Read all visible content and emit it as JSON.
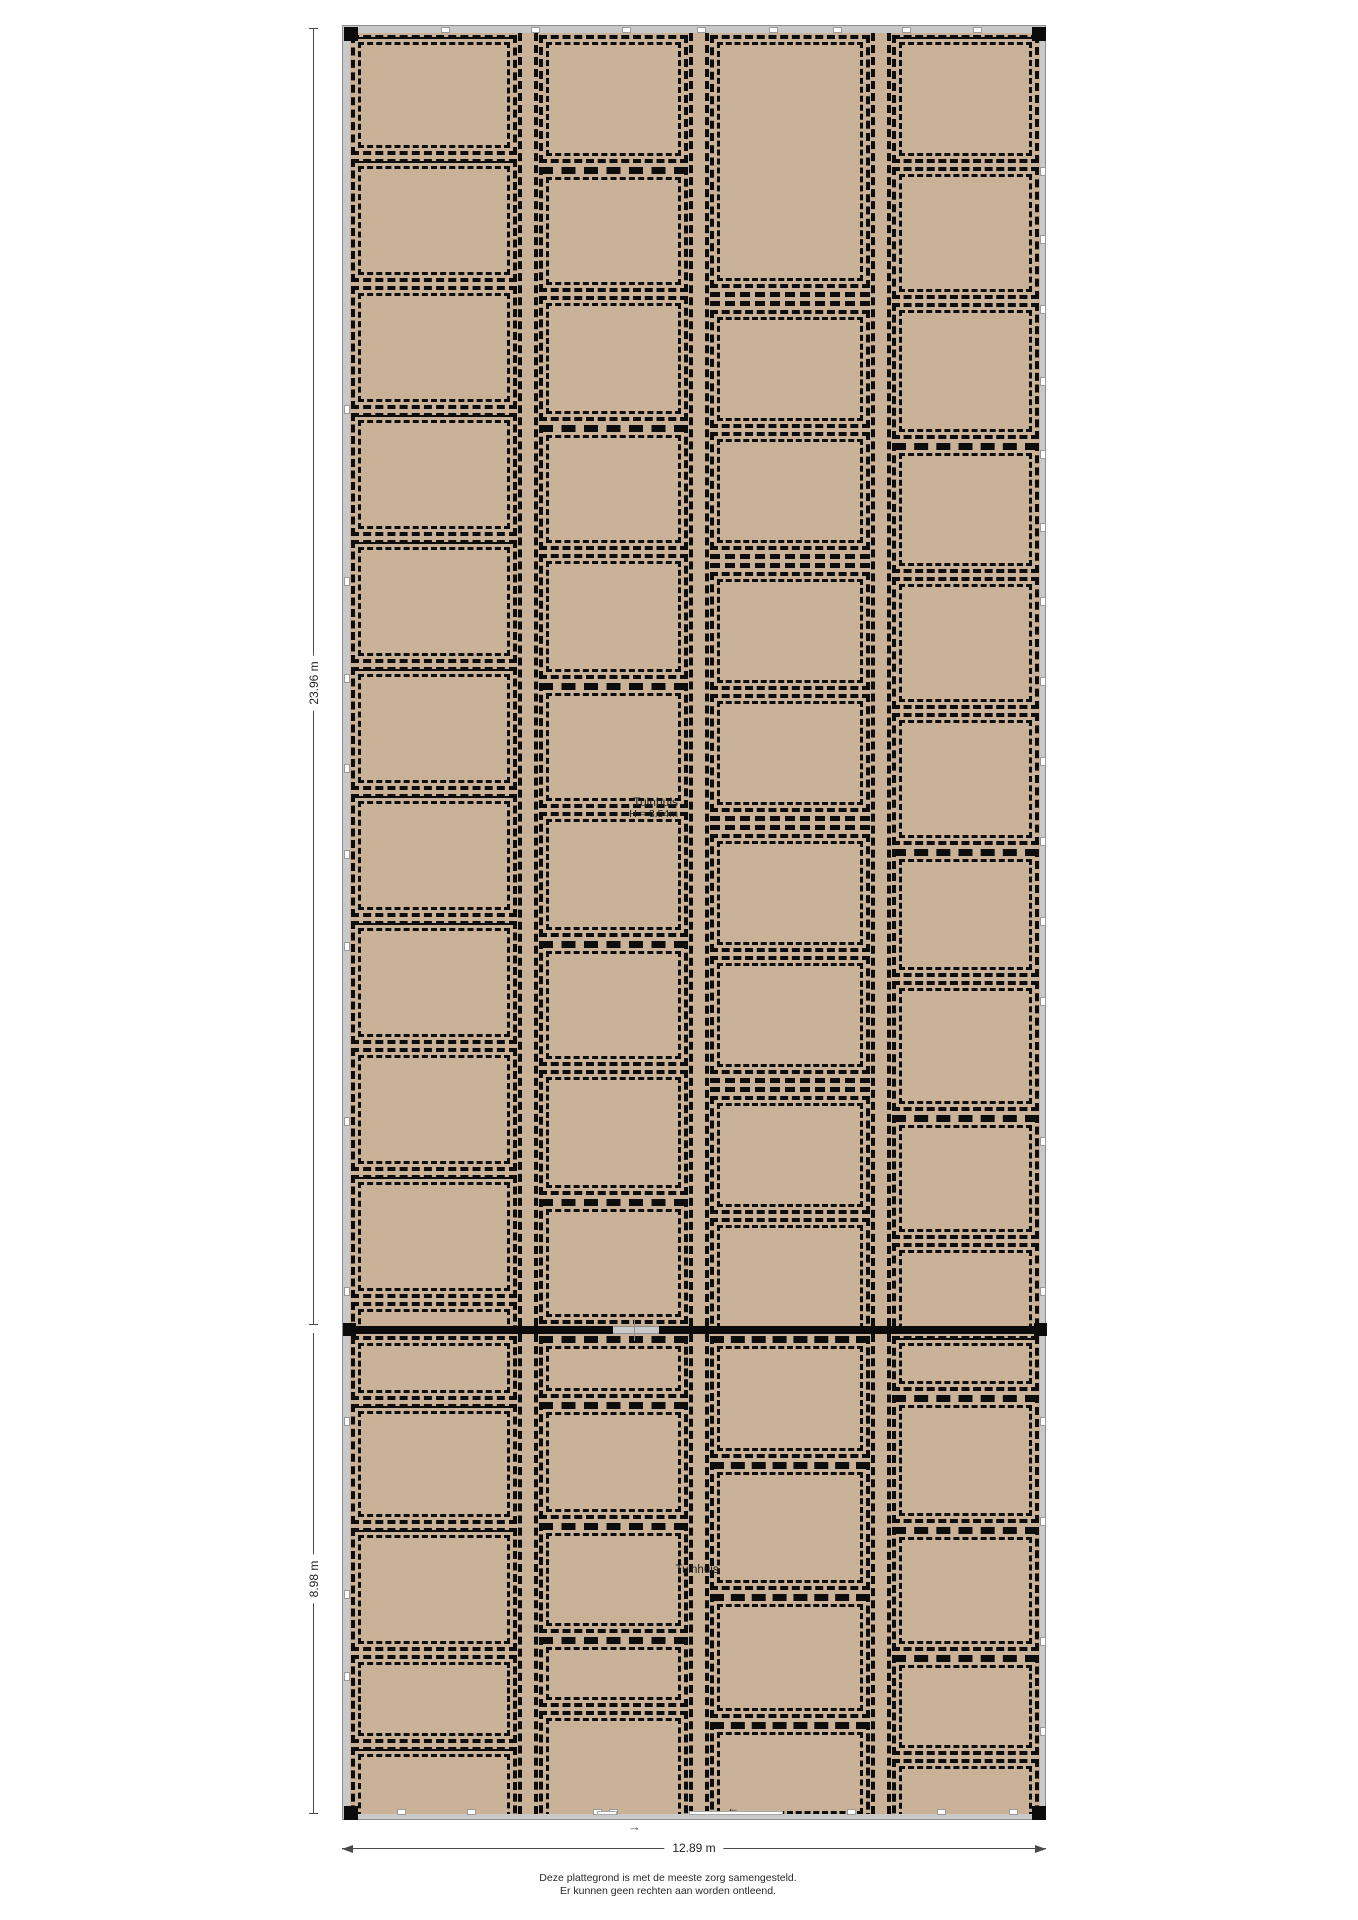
{
  "colors": {
    "floor": "#c9b297",
    "wall": "#c9c9c9",
    "wall_edge": "#8e8e8e",
    "line": "#0d0d0d",
    "dim": "#4a4a4a"
  },
  "dimensions": {
    "left_upper": {
      "label": "23.96 m"
    },
    "left_lower": {
      "label": "8.98 m"
    },
    "bottom": {
      "label": "12.89 m"
    }
  },
  "labels": {
    "tuinhuis_upper": {
      "line1": "Tuinhuis",
      "line2": "H = 3.54m"
    },
    "tuinhuis_lower": "Tuinhuis",
    "arrow_below_wall": "→",
    "arrow_inside": "←"
  },
  "disclaimer": [
    "Deze plattegrond is met de meeste zorg samengesteld.",
    "Er kunnen geen rechten aan worden ontleend."
  ],
  "plan": {
    "column_widths": [
      168,
      151,
      162,
      149
    ],
    "separator_width": 20,
    "upper": {
      "top": 7,
      "height": 1293,
      "columns": [
        [
          {
            "h": 120,
            "v": "s"
          },
          {
            "h": 123,
            "v": "s"
          },
          {
            "h": 123,
            "v": "p"
          },
          {
            "h": 123,
            "v": "s"
          },
          {
            "h": 123,
            "v": "s"
          },
          {
            "h": 123,
            "v": "s"
          },
          {
            "h": 123,
            "v": "s"
          },
          {
            "h": 123,
            "v": "s"
          },
          {
            "h": 123,
            "v": "p"
          },
          {
            "h": 123,
            "v": "s"
          },
          {
            "h": 66,
            "v": "p"
          }
        ],
        [
          {
            "h": 128,
            "v": "p"
          },
          {
            "h": 125,
            "v": "t"
          },
          {
            "h": 125,
            "v": "p"
          },
          {
            "h": 125,
            "v": "t"
          },
          {
            "h": 125,
            "v": "p"
          },
          {
            "h": 125,
            "v": "t"
          },
          {
            "h": 125,
            "v": "p"
          },
          {
            "h": 125,
            "v": "t"
          },
          {
            "h": 125,
            "v": "p"
          },
          {
            "h": 125,
            "v": "t"
          },
          {
            "h": 40,
            "v": "p"
          }
        ],
        [
          {
            "h": 253,
            "v": "p"
          },
          {
            "h": 14,
            "v": "b"
          },
          {
            "h": 118,
            "v": "p"
          },
          {
            "h": 118,
            "v": "p"
          },
          {
            "h": 14,
            "v": "b"
          },
          {
            "h": 118,
            "v": "p"
          },
          {
            "h": 118,
            "v": "p"
          },
          {
            "h": 14,
            "v": "b"
          },
          {
            "h": 118,
            "v": "p"
          },
          {
            "h": 118,
            "v": "p"
          },
          {
            "h": 14,
            "v": "b"
          },
          {
            "h": 118,
            "v": "p"
          },
          {
            "h": 118,
            "v": "p"
          },
          {
            "h": 40,
            "v": "p"
          }
        ],
        [
          {
            "h": 128,
            "v": "s"
          },
          {
            "h": 132,
            "v": "p"
          },
          {
            "h": 136,
            "v": "p"
          },
          {
            "h": 130,
            "v": "t"
          },
          {
            "h": 132,
            "v": "p"
          },
          {
            "h": 132,
            "v": "p"
          },
          {
            "h": 128,
            "v": "t"
          },
          {
            "h": 130,
            "v": "p"
          },
          {
            "h": 124,
            "v": "t"
          },
          {
            "h": 121,
            "v": "p"
          }
        ]
      ]
    },
    "lower": {
      "top": 1308,
      "height": 480,
      "columns": [
        [
          {
            "h": 64,
            "v": "p"
          },
          {
            "h": 120,
            "v": "s"
          },
          {
            "h": 123,
            "v": "s"
          },
          {
            "h": 88,
            "v": "p"
          },
          {
            "h": 78,
            "v": "s"
          }
        ],
        [
          {
            "h": 62,
            "v": "t"
          },
          {
            "h": 117,
            "v": "t"
          },
          {
            "h": 110,
            "v": "t"
          },
          {
            "h": 70,
            "v": "t"
          },
          {
            "h": 114,
            "v": "p"
          }
        ],
        [
          {
            "h": 122,
            "v": "t"
          },
          {
            "h": 128,
            "v": "t"
          },
          {
            "h": 124,
            "v": "t"
          },
          {
            "h": 99,
            "v": "t"
          }
        ],
        [
          {
            "h": 55,
            "v": "s"
          },
          {
            "h": 128,
            "v": "t"
          },
          {
            "h": 124,
            "v": "t"
          },
          {
            "h": 100,
            "v": "t"
          },
          {
            "h": 66,
            "v": "p"
          }
        ]
      ]
    },
    "divider": {
      "top": 1300,
      "height": 8,
      "gap_x1": 270,
      "gap_x2": 316,
      "tick_x": 291
    },
    "ticks": {
      "top_x": [
        102,
        192,
        283,
        358,
        430,
        494,
        563,
        634
      ],
      "bottom_x": [
        58,
        128,
        254,
        270,
        508,
        598,
        670
      ],
      "left_y": [
        383,
        555,
        652,
        742,
        828,
        920,
        1095,
        1265,
        1395,
        1568,
        1650
      ],
      "right_y": [
        145,
        213,
        283,
        355,
        428,
        501,
        575,
        655,
        735,
        815,
        895,
        975,
        1115,
        1265,
        1395,
        1495,
        1615,
        1705
      ]
    },
    "openings_bottom": [
      [
        254,
        274
      ],
      [
        346,
        440
      ]
    ]
  }
}
